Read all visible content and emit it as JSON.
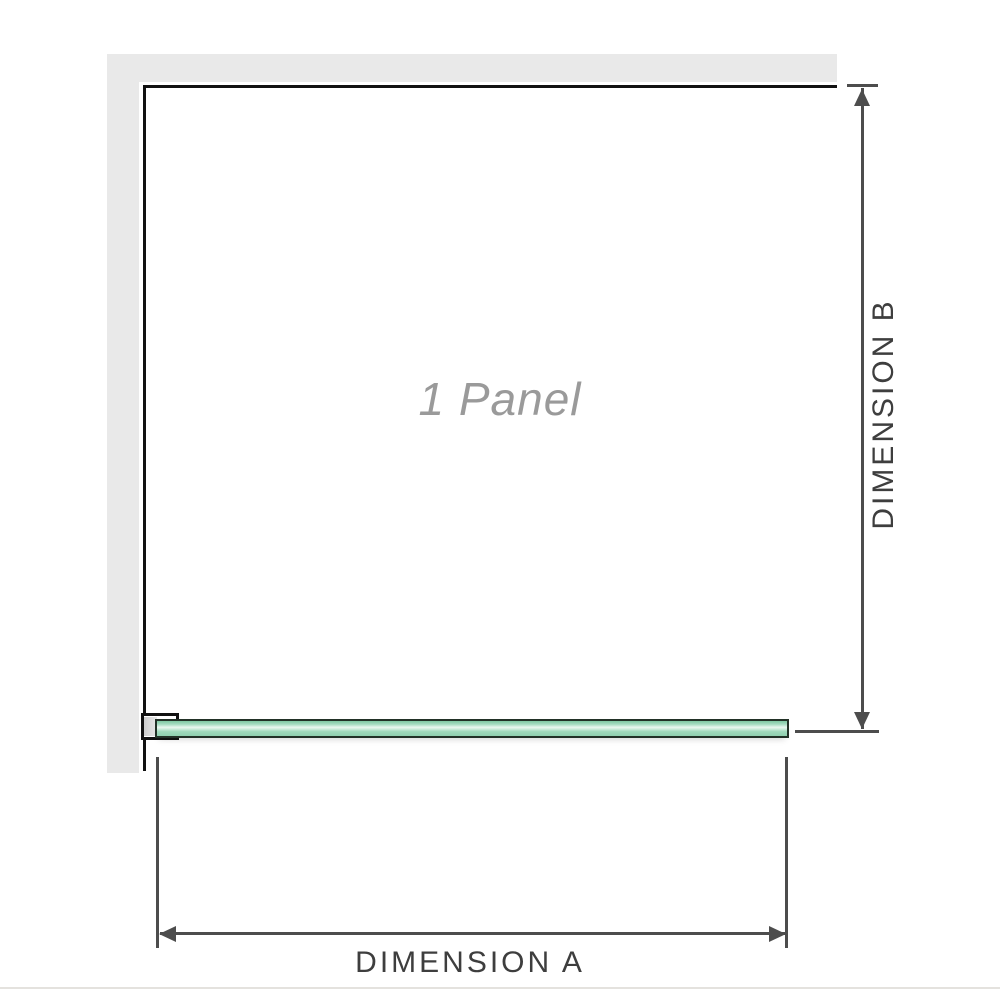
{
  "diagram": {
    "panel_label": "1 Panel",
    "dimension_a": {
      "label": "DIMENSION A"
    },
    "dimension_b": {
      "label": "DIMENSION B"
    }
  },
  "colors": {
    "wall": "#e9e9e9",
    "outline": "#111111",
    "dimension": "#4d4d4d",
    "label_text": "#3e3e3e",
    "panel_text": "#9a9a9a",
    "glass_border": "#223127",
    "glass_fill": "#9ad7b7",
    "glass_highlight": "#eaf7f0",
    "footer_line": "#e4e2de"
  }
}
